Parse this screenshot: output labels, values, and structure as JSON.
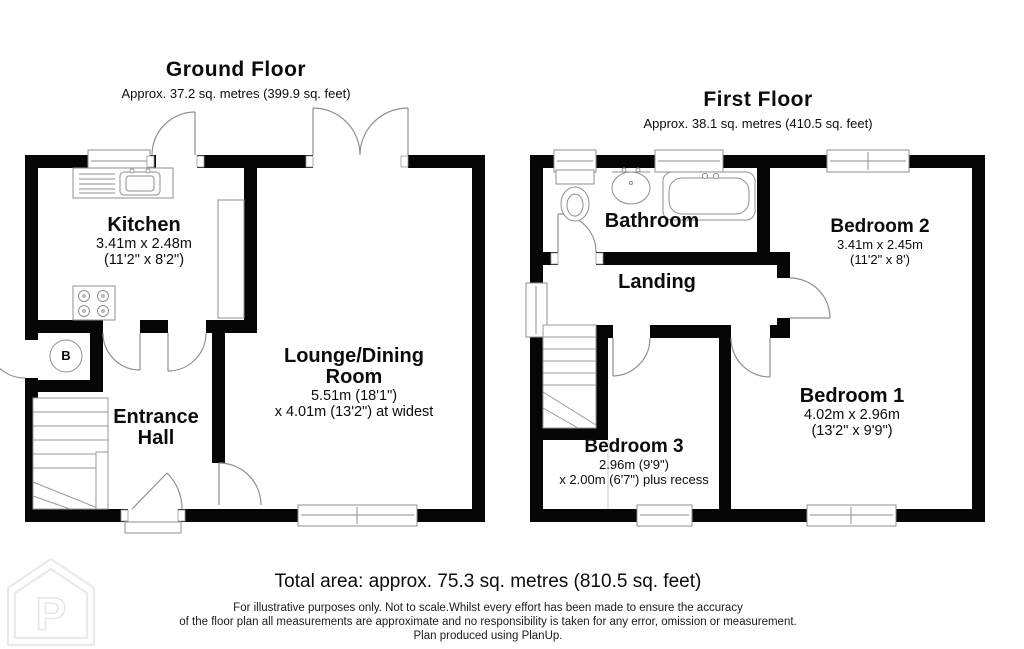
{
  "ground_floor": {
    "title": "Ground Floor",
    "subtitle": "Approx. 37.2 sq. metres (399.9 sq. feet)",
    "kitchen": {
      "name": "Kitchen",
      "dims_metric": "3.41m x 2.48m",
      "dims_imperial": "(11'2\" x 8'2\")"
    },
    "lounge": {
      "name_line1": "Lounge/Dining",
      "name_line2": "Room",
      "dims_line1": "5.51m (18'1\")",
      "dims_line2": "x 4.01m (13'2\") at widest"
    },
    "entrance_hall": {
      "name_line1": "Entrance",
      "name_line2": "Hall"
    },
    "boiler": {
      "label": "B"
    }
  },
  "first_floor": {
    "title": "First Floor",
    "subtitle": "Approx. 38.1 sq. metres (410.5 sq. feet)",
    "bathroom": {
      "name": "Bathroom"
    },
    "landing": {
      "name": "Landing"
    },
    "bedroom2": {
      "name": "Bedroom 2",
      "dims_metric": "3.41m x 2.45m",
      "dims_imperial": "(11'2\" x 8')"
    },
    "bedroom1": {
      "name": "Bedroom 1",
      "dims_metric": "4.02m x 2.96m",
      "dims_imperial": "(13'2\" x 9'9\")"
    },
    "bedroom3": {
      "name": "Bedroom 3",
      "dims_line1": "2.96m (9'9\")",
      "dims_line2": "x 2.00m (6'7\") plus recess"
    }
  },
  "footer": {
    "total_area": "Total area: approx. 75.3 sq. metres (810.5 sq. feet)",
    "disclaimer_line1": "For illustrative purposes only. Not to scale.Whilst every effort has been made to ensure the accuracy",
    "disclaimer_line2": "of the floor plan all measurements are approximate and no responsibility is taken for any error, omission or measurement.",
    "disclaimer_line3": "Plan produced using PlanUp.",
    "logo_letter": "P"
  },
  "colors": {
    "wall": "#060606",
    "fixture": "#8f8f8f",
    "text": "#0c0c0c",
    "logo": "#eceae8"
  }
}
